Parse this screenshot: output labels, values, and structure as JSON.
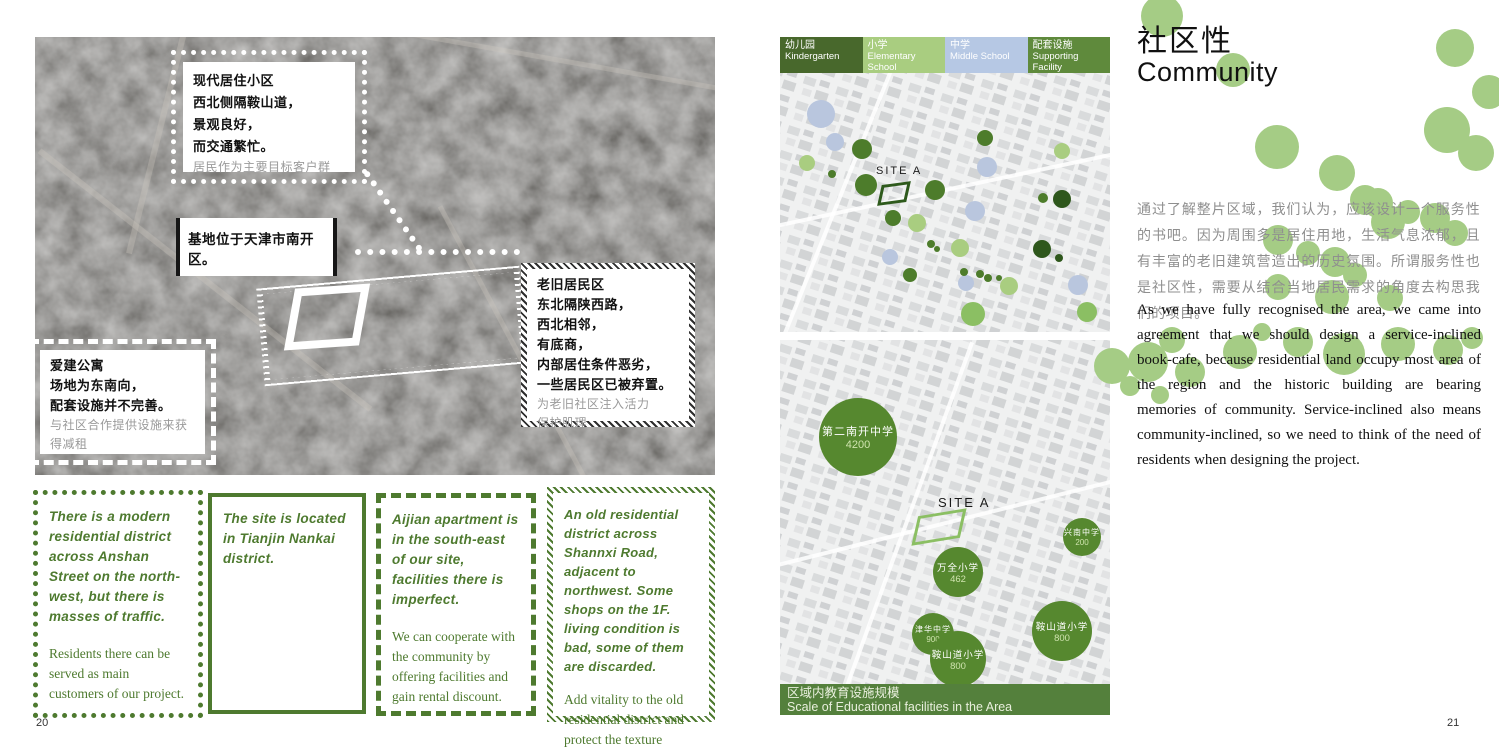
{
  "page_left": {
    "page_number": "20",
    "annotations": {
      "modern": {
        "bold": [
          "现代居住小区",
          "西北侧隔鞍山道，",
          "景观良好，",
          "而交通繁忙。"
        ],
        "gray": [
          "居民作为主要目标客户群"
        ]
      },
      "site": {
        "bold": [
          "基地位于天津市南开区。"
        ],
        "gray": []
      },
      "old": {
        "bold": [
          "老旧居民区",
          "东北隔陕西路，",
          "西北相邻，",
          "有底商，",
          "内部居住条件恶劣，",
          "一些居民区已被弃置。"
        ],
        "gray": [
          "为老旧社区注入活力",
          "保护肌理"
        ]
      },
      "aijian": {
        "bold": [
          "爱建公寓",
          "场地为东南向，",
          "配套设施并不完善。"
        ],
        "gray": [
          "与社区合作提供设施来获",
          "得减租"
        ]
      }
    },
    "columns": [
      {
        "highlight": "There is a modern residential district across Anshan Street on the north-west, but there is masses of traffic.",
        "body": "Residents there can be served as main customers of our project."
      },
      {
        "highlight": "The site is located in Tianjin Nankai district.",
        "body": ""
      },
      {
        "highlight": "Aijian apartment is in the south-east of our site, facilities there is imperfect.",
        "body": "We can cooperate with the community by offering facilities and gain rental discount."
      },
      {
        "highlight": "An old residential district across Shannxi Road, adjacent to northwest. Some shops on the 1F. living condition is bad, some of them are discarded.",
        "body": "Add vitality to the old residential district and protect the texture"
      }
    ]
  },
  "page_right": {
    "page_number": "21",
    "title_zh": "社区性",
    "title_en": "Community",
    "legend": [
      {
        "zh": "幼儿园",
        "en": "Kindergarten",
        "color": "#48682c"
      },
      {
        "zh": "小学",
        "en": "Elementary School",
        "color": "#a9cd80"
      },
      {
        "zh": "中学",
        "en": "Middle School",
        "color": "#b6c8e4"
      },
      {
        "zh": "配套设施",
        "en": "Supporting Facility",
        "color": "#5f8a3c"
      }
    ],
    "paragraph_zh": "通过了解整片区域，我们认为，应该设计一个服务性的书吧。因为周围多是居住用地，生活气息浓郁，且有丰富的老旧建筑营造出的历史氛围。所谓服务性也是社区性，需要从结合当地居民需求的角度去构思我们的项目。",
    "paragraph_en": "As we have fully recognised the area, we came into agreement that we should design a service-inclined book-cafe, because residential land occupy most area of the region and the historic building are bearing memories of community. Service-inclined also means community-inclined, so we need to think of the need of residents when designing the project.",
    "caption_zh": "区域内教育设施规模",
    "caption_en": "Scale of Educational facilities in the Area",
    "site_label": "SITE A",
    "maps": {
      "schools": [
        {
          "name": "第二南开中学",
          "value": "4200",
          "x": 78,
          "y": 97,
          "r": 39
        },
        {
          "name": "万全小学",
          "value": "462",
          "x": 178,
          "y": 232,
          "r": 25
        },
        {
          "name": "兴南中学",
          "value": "200",
          "x": 302,
          "y": 197,
          "r": 19
        },
        {
          "name": "津华中学",
          "value": "900",
          "x": 153,
          "y": 294,
          "r": 21
        },
        {
          "name": "鞍山道小学",
          "value": "800",
          "x": 178,
          "y": 319,
          "r": 28
        },
        {
          "name": "鞍山道小学",
          "value": "800",
          "x": 282,
          "y": 291,
          "r": 30
        }
      ],
      "facility_dots": [
        {
          "x": 41,
          "y": 77,
          "r": 14,
          "c": "middle"
        },
        {
          "x": 55,
          "y": 105,
          "r": 9,
          "c": "middle"
        },
        {
          "x": 207,
          "y": 130,
          "r": 10,
          "c": "middle"
        },
        {
          "x": 195,
          "y": 174,
          "r": 10,
          "c": "middle"
        },
        {
          "x": 110,
          "y": 220,
          "r": 8,
          "c": "middle"
        },
        {
          "x": 186,
          "y": 246,
          "r": 8,
          "c": "middle"
        },
        {
          "x": 298,
          "y": 248,
          "r": 10,
          "c": "middle"
        },
        {
          "x": 82,
          "y": 112,
          "r": 10,
          "c": "kindergarten"
        },
        {
          "x": 52,
          "y": 137,
          "r": 4,
          "c": "kindergarten"
        },
        {
          "x": 86,
          "y": 148,
          "r": 11,
          "c": "kindergarten"
        },
        {
          "x": 205,
          "y": 101,
          "r": 8,
          "c": "kindergarten"
        },
        {
          "x": 155,
          "y": 153,
          "r": 10,
          "c": "kindergarten"
        },
        {
          "x": 113,
          "y": 181,
          "r": 8,
          "c": "kindergarten"
        },
        {
          "x": 151,
          "y": 207,
          "r": 4,
          "c": "kindergarten"
        },
        {
          "x": 157,
          "y": 212,
          "r": 3,
          "c": "kindergarten"
        },
        {
          "x": 130,
          "y": 238,
          "r": 7,
          "c": "kindergarten"
        },
        {
          "x": 184,
          "y": 235,
          "r": 4,
          "c": "kindergarten"
        },
        {
          "x": 200,
          "y": 237,
          "r": 4,
          "c": "kindergarten"
        },
        {
          "x": 208,
          "y": 241,
          "r": 4,
          "c": "kindergarten"
        },
        {
          "x": 219,
          "y": 241,
          "r": 3,
          "c": "kindergarten"
        },
        {
          "x": 263,
          "y": 161,
          "r": 5,
          "c": "kindergarten"
        },
        {
          "x": 282,
          "y": 162,
          "r": 9,
          "c": "supporting_dark"
        },
        {
          "x": 262,
          "y": 212,
          "r": 9,
          "c": "supporting_dark"
        },
        {
          "x": 279,
          "y": 221,
          "r": 4,
          "c": "supporting_dark"
        },
        {
          "x": 27,
          "y": 126,
          "r": 8,
          "c": "elementary"
        },
        {
          "x": 282,
          "y": 114,
          "r": 8,
          "c": "elementary"
        },
        {
          "x": 137,
          "y": 186,
          "r": 9,
          "c": "elementary"
        },
        {
          "x": 180,
          "y": 211,
          "r": 9,
          "c": "elementary"
        },
        {
          "x": 229,
          "y": 249,
          "r": 9,
          "c": "elementary"
        },
        {
          "x": 193,
          "y": 277,
          "r": 12,
          "c": "supporting"
        },
        {
          "x": 307,
          "y": 275,
          "r": 10,
          "c": "supporting"
        }
      ],
      "dot_colors": {
        "kindergarten": "#4d7c2b",
        "elementary": "#a9cd80",
        "middle": "#b9c6de",
        "supporting": "#8bbf63",
        "supporting_dark": "#2e571c",
        "school_bubble": "#56882f"
      }
    }
  },
  "deco_circles": [
    {
      "x": 1162,
      "y": 16,
      "r": 21
    },
    {
      "x": 1233,
      "y": 70,
      "r": 17
    },
    {
      "x": 1455,
      "y": 48,
      "r": 19
    },
    {
      "x": 1489,
      "y": 92,
      "r": 17
    },
    {
      "x": 1447,
      "y": 130,
      "r": 23
    },
    {
      "x": 1476,
      "y": 153,
      "r": 18
    },
    {
      "x": 1277,
      "y": 147,
      "r": 22
    },
    {
      "x": 1337,
      "y": 173,
      "r": 18
    },
    {
      "x": 1378,
      "y": 203,
      "r": 15
    },
    {
      "x": 1365,
      "y": 200,
      "r": 15
    },
    {
      "x": 1388,
      "y": 222,
      "r": 17
    },
    {
      "x": 1408,
      "y": 212,
      "r": 12
    },
    {
      "x": 1435,
      "y": 218,
      "r": 15
    },
    {
      "x": 1455,
      "y": 233,
      "r": 13
    },
    {
      "x": 1278,
      "y": 240,
      "r": 15
    },
    {
      "x": 1308,
      "y": 253,
      "r": 12
    },
    {
      "x": 1335,
      "y": 262,
      "r": 15
    },
    {
      "x": 1355,
      "y": 275,
      "r": 12
    },
    {
      "x": 1278,
      "y": 287,
      "r": 13
    },
    {
      "x": 1332,
      "y": 297,
      "r": 17
    },
    {
      "x": 1330,
      "y": 300,
      "r": 11
    },
    {
      "x": 1390,
      "y": 298,
      "r": 13
    },
    {
      "x": 1148,
      "y": 362,
      "r": 20
    },
    {
      "x": 1172,
      "y": 340,
      "r": 13
    },
    {
      "x": 1190,
      "y": 372,
      "r": 15
    },
    {
      "x": 1240,
      "y": 352,
      "r": 17
    },
    {
      "x": 1262,
      "y": 332,
      "r": 9
    },
    {
      "x": 1298,
      "y": 342,
      "r": 15
    },
    {
      "x": 1344,
      "y": 354,
      "r": 21
    },
    {
      "x": 1398,
      "y": 344,
      "r": 17
    },
    {
      "x": 1448,
      "y": 350,
      "r": 15
    },
    {
      "x": 1472,
      "y": 338,
      "r": 11
    },
    {
      "x": 1112,
      "y": 366,
      "r": 18
    },
    {
      "x": 1130,
      "y": 386,
      "r": 10
    },
    {
      "x": 1160,
      "y": 395,
      "r": 9
    }
  ]
}
